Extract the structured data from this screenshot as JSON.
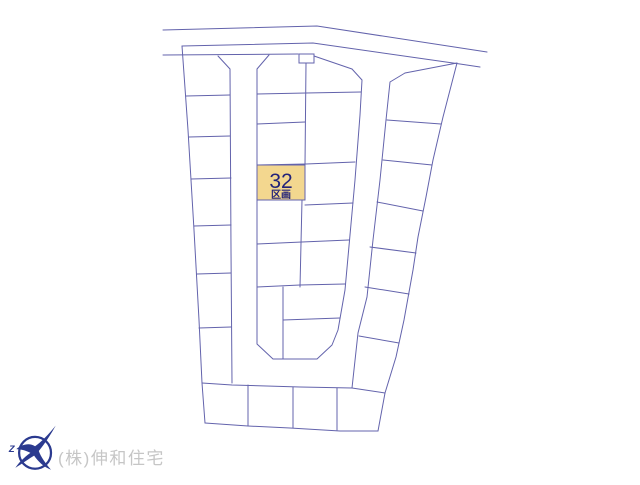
{
  "site_plan": {
    "line_color": "#6363ac",
    "background": "#ffffff",
    "highlighted_lot": {
      "number": "32",
      "suffix": "区画",
      "x": 257,
      "y": 165,
      "w": 48,
      "h": 35,
      "fill": "#f3d78f",
      "text_color": "#23237a"
    },
    "sign_box": {
      "x": 299,
      "y": 54,
      "w": 15,
      "h": 9
    },
    "polylines": [
      {
        "name": "top-road-far-edge",
        "points": [
          [
            163,
            30
          ],
          [
            317,
            26
          ],
          [
            487,
            52
          ]
        ]
      },
      {
        "name": "top-road-near-edge",
        "points": [
          [
            182,
            46
          ],
          [
            313,
            43
          ],
          [
            460,
            64
          ],
          [
            480,
            67
          ]
        ]
      },
      {
        "name": "north-boundary-line",
        "points": [
          [
            163,
            55
          ],
          [
            298,
            54
          ]
        ]
      },
      {
        "name": "mid-column-top-edge",
        "points": [
          [
            314,
            56
          ],
          [
            352,
            69
          ]
        ]
      },
      {
        "name": "right-column-top-edge",
        "points": [
          [
            405,
            73
          ],
          [
            457,
            63
          ]
        ]
      },
      {
        "name": "left-boundary",
        "points": [
          [
            182,
            46
          ],
          [
            188,
            130
          ],
          [
            194,
            230
          ],
          [
            199,
            320
          ],
          [
            202,
            383
          ],
          [
            205,
            423
          ]
        ]
      },
      {
        "name": "bottom-boundary",
        "points": [
          [
            205,
            423
          ],
          [
            248,
            426
          ],
          [
            290,
            428
          ],
          [
            340,
            431
          ],
          [
            378,
            431
          ]
        ]
      },
      {
        "name": "right-boundary",
        "points": [
          [
            457,
            63
          ],
          [
            443,
            117
          ],
          [
            433,
            160
          ],
          [
            426,
            197
          ],
          [
            418,
            237
          ],
          [
            413,
            270
          ],
          [
            404,
            320
          ],
          [
            396,
            357
          ],
          [
            385,
            393
          ],
          [
            378,
            431
          ]
        ]
      },
      {
        "name": "left-road-outer-edge",
        "points": [
          [
            218,
            56
          ],
          [
            230,
            69
          ],
          [
            231,
            250
          ],
          [
            232,
            383
          ]
        ]
      },
      {
        "name": "bottom-road-outer-edge",
        "points": [
          [
            202,
            383
          ],
          [
            232,
            385
          ],
          [
            300,
            387
          ],
          [
            352,
            388
          ]
        ]
      },
      {
        "name": "right-road-outer-edge",
        "points": [
          [
            352,
            388
          ],
          [
            358,
            333
          ],
          [
            367,
            297
          ],
          [
            373,
            240
          ],
          [
            380,
            180
          ],
          [
            386,
            120
          ],
          [
            390,
            82
          ],
          [
            405,
            73
          ]
        ]
      },
      {
        "name": "inner-block-outline",
        "points": [
          [
            269,
            55
          ],
          [
            257,
            69
          ],
          [
            257,
            344
          ],
          [
            273,
            359
          ],
          [
            317,
            359
          ],
          [
            332,
            345
          ],
          [
            338,
            330
          ],
          [
            345,
            290
          ],
          [
            355,
            180
          ],
          [
            360,
            115
          ],
          [
            362,
            80
          ],
          [
            352,
            69
          ]
        ]
      },
      {
        "name": "left-col-divider-1",
        "points": [
          [
            186,
            96
          ],
          [
            230,
            95
          ]
        ]
      },
      {
        "name": "left-col-divider-2",
        "points": [
          [
            189,
            137
          ],
          [
            230,
            136
          ]
        ]
      },
      {
        "name": "left-col-divider-3",
        "points": [
          [
            191,
            179
          ],
          [
            231,
            178
          ]
        ]
      },
      {
        "name": "left-col-divider-4",
        "points": [
          [
            194,
            226
          ],
          [
            231,
            225
          ]
        ]
      },
      {
        "name": "left-col-divider-5",
        "points": [
          [
            197,
            274
          ],
          [
            231,
            273
          ]
        ]
      },
      {
        "name": "left-col-divider-6",
        "points": [
          [
            199,
            328
          ],
          [
            231,
            327
          ]
        ]
      },
      {
        "name": "mid-divider-h1",
        "points": [
          [
            257,
            94
          ],
          [
            306,
            93
          ],
          [
            361,
            92
          ]
        ]
      },
      {
        "name": "mid-divider-h2",
        "points": [
          [
            257,
            124
          ],
          [
            305,
            122
          ]
        ]
      },
      {
        "name": "mid-divider-h3",
        "points": [
          [
            257,
            165
          ],
          [
            306,
            164
          ],
          [
            355,
            162
          ]
        ]
      },
      {
        "name": "mid-divider-h4-left",
        "points": [
          [
            257,
            200
          ],
          [
            305,
            198
          ]
        ]
      },
      {
        "name": "mid-divider-h4-right",
        "points": [
          [
            305,
            205
          ],
          [
            353,
            203
          ]
        ]
      },
      {
        "name": "mid-divider-h5",
        "points": [
          [
            257,
            244
          ],
          [
            302,
            242
          ],
          [
            349,
            240
          ]
        ]
      },
      {
        "name": "mid-divider-h6",
        "points": [
          [
            257,
            287
          ],
          [
            300,
            285
          ],
          [
            345,
            284
          ]
        ]
      },
      {
        "name": "mid-divider-h7",
        "points": [
          [
            283,
            320
          ],
          [
            340,
            318
          ]
        ]
      },
      {
        "name": "mid-divider-v1",
        "points": [
          [
            306,
            63
          ],
          [
            305,
            165
          ]
        ]
      },
      {
        "name": "mid-divider-v2",
        "points": [
          [
            302,
            200
          ],
          [
            300,
            287
          ]
        ]
      },
      {
        "name": "mid-divider-v3",
        "points": [
          [
            283,
            287
          ],
          [
            283,
            359
          ]
        ]
      },
      {
        "name": "right-col-divider-1",
        "points": [
          [
            387,
            120
          ],
          [
            441,
            124
          ]
        ]
      },
      {
        "name": "right-col-divider-2",
        "points": [
          [
            383,
            160
          ],
          [
            432,
            165
          ]
        ]
      },
      {
        "name": "right-col-divider-3",
        "points": [
          [
            377,
            202
          ],
          [
            423,
            211
          ]
        ]
      },
      {
        "name": "right-col-divider-4",
        "points": [
          [
            370,
            247
          ],
          [
            416,
            253
          ]
        ]
      },
      {
        "name": "right-col-divider-5",
        "points": [
          [
            365,
            287
          ],
          [
            409,
            294
          ]
        ]
      },
      {
        "name": "right-col-divider-6",
        "points": [
          [
            359,
            336
          ],
          [
            399,
            343
          ]
        ]
      },
      {
        "name": "right-col-bottom-edge",
        "points": [
          [
            352,
            388
          ],
          [
            385,
            393
          ]
        ]
      },
      {
        "name": "bottom-row-divider-1",
        "points": [
          [
            248,
            385
          ],
          [
            248,
            426
          ]
        ]
      },
      {
        "name": "bottom-row-divider-2",
        "points": [
          [
            293,
            387
          ],
          [
            293,
            428
          ]
        ]
      },
      {
        "name": "bottom-row-divider-3",
        "points": [
          [
            337,
            388
          ],
          [
            337,
            430
          ]
        ]
      }
    ]
  },
  "footer": {
    "company": "(株)伸和住宅",
    "text_color": "#c6c6c6",
    "logo_color": "#2b3a8f",
    "logo_mark": "Z"
  }
}
